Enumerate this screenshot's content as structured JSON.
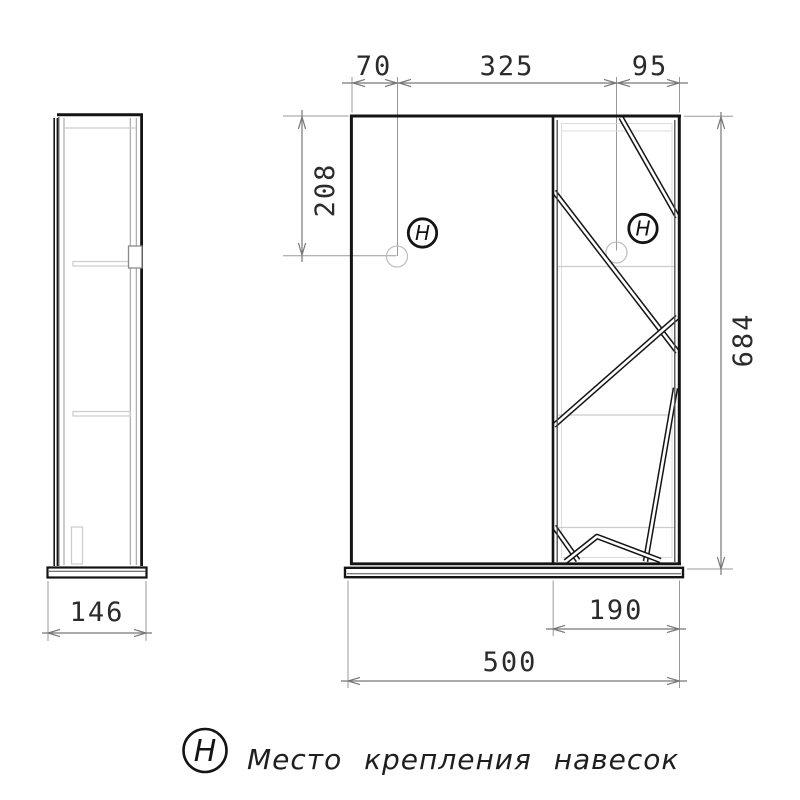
{
  "legend": {
    "symbol": "H",
    "text": "Место крепления навесок"
  },
  "marker": {
    "symbol": "H"
  },
  "dims": {
    "hanger_offset_left": "70",
    "hanger_spacing": "325",
    "hanger_offset_right": "95",
    "hanger_drop": "208",
    "height": "684",
    "depth": "146",
    "door_width": "190",
    "width": "500"
  },
  "colors": {
    "outline": "#141414",
    "dim_line": "#777777",
    "ext_line": "#999999",
    "faint": "#cccccc",
    "text": "#2b2b2b",
    "background": "#ffffff"
  }
}
